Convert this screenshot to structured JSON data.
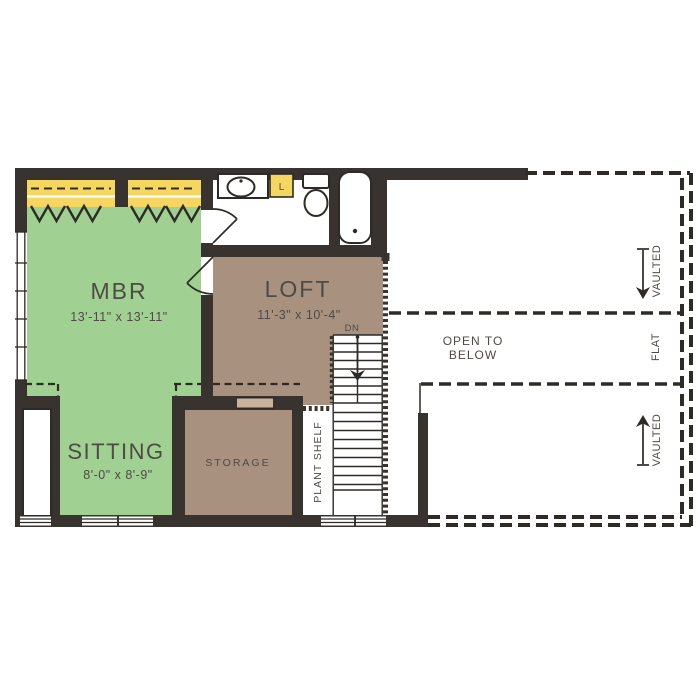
{
  "rooms": {
    "mbr": {
      "name": "MBR",
      "dims": "13'-11\" x 13'-11\""
    },
    "loft": {
      "name": "LOFT",
      "dims": "11'-3\" x 10'-4\""
    },
    "sitting": {
      "name": "SITTING",
      "dims": "8'-0\" x 8'-9\""
    },
    "storage": {
      "name": "STORAGE"
    },
    "plant_shelf": {
      "name": "PLANT SHELF"
    }
  },
  "annotations": {
    "open_to_line1": "OPEN TO",
    "open_to_line2": "BELOW",
    "vaulted_upper": "VAULTED",
    "flat": "FLAT",
    "vaulted_lower": "VAULTED",
    "stair_direction": "DN",
    "linen_closet": "L"
  },
  "colors": {
    "wall": "#38332f",
    "line": "#2e2a26",
    "room_green": "#a0d192",
    "room_brown": "#a8927f",
    "closet_yellow": "#f5d660",
    "opening_tan": "#c9b39e",
    "text": "#4f4a44",
    "background": "#ffffff"
  }
}
